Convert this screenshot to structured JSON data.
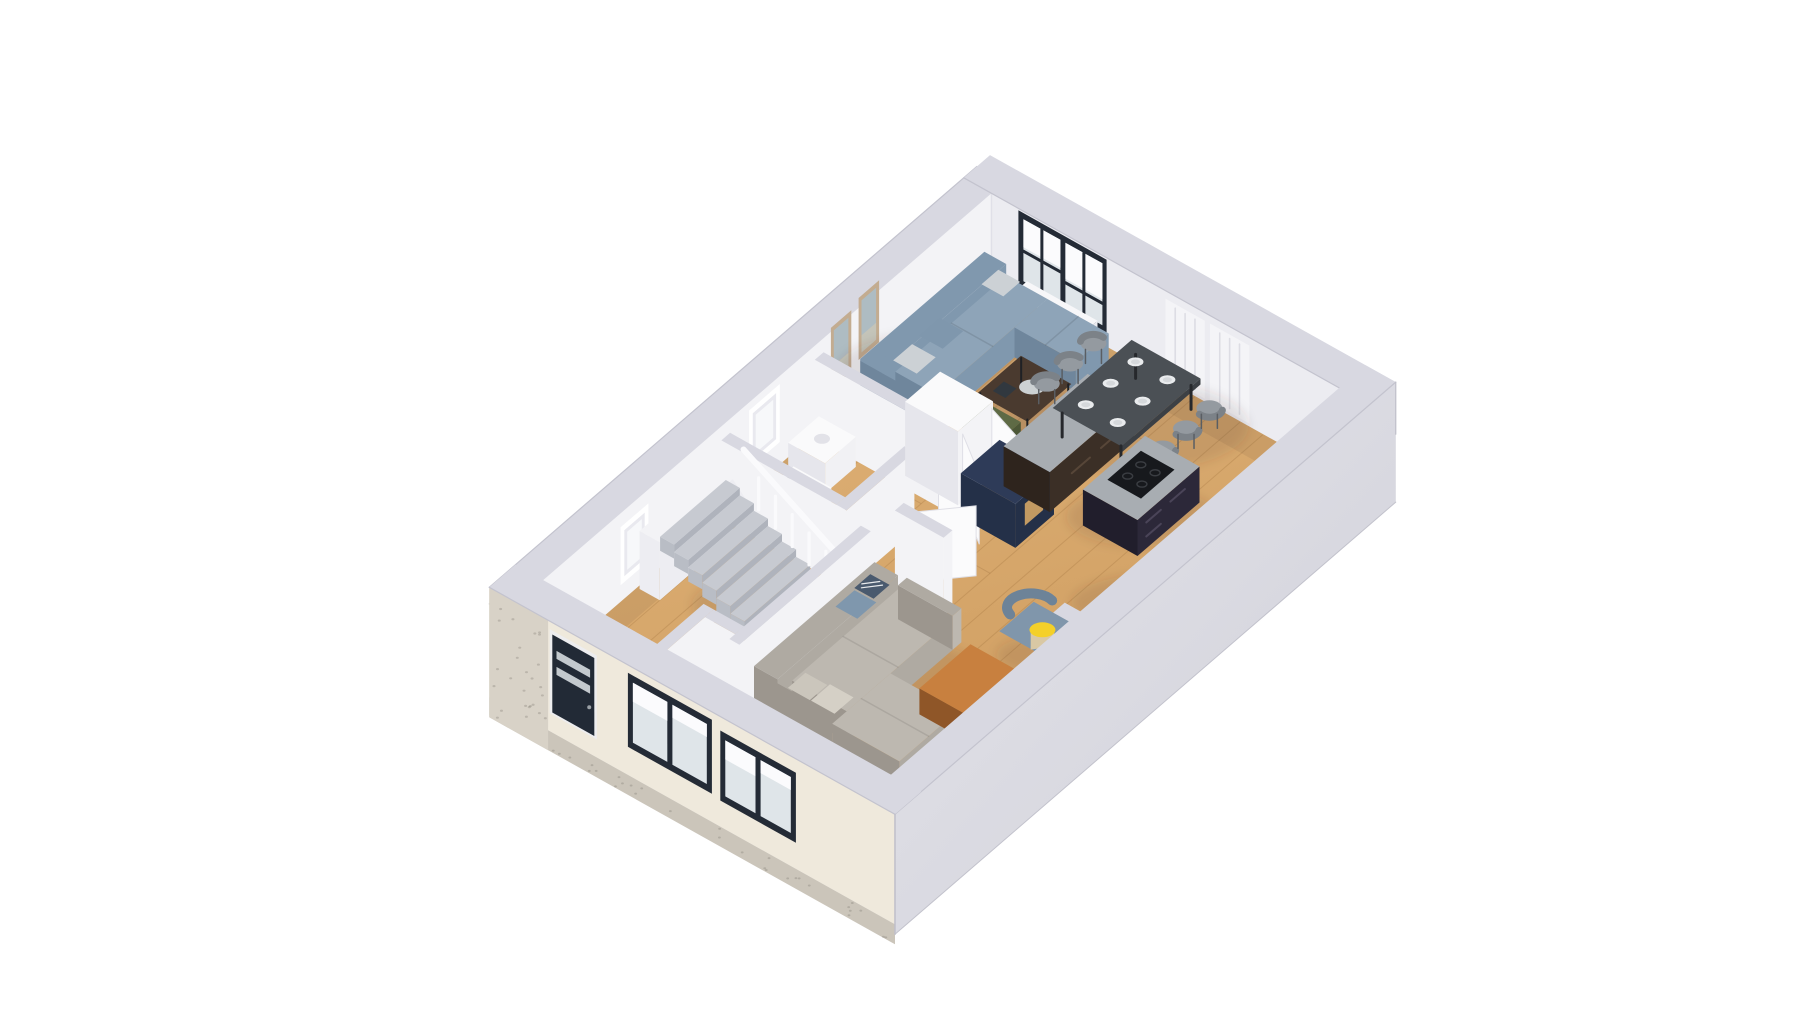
{
  "scene": {
    "type": "3d-floor-plan-render",
    "view": "isometric-top-down",
    "background": "#ffffff"
  },
  "palette": {
    "background": "#ffffff",
    "floor_light": "#DFB277",
    "floor_dark": "#CE9C5F",
    "plank_line": "rgba(139,94,45,0.22)",
    "plank_seam": "rgba(120,80,40,0.18)",
    "wall_interior": "#F3F3F6",
    "wall_interior_2": "#ECECF1",
    "wall_top": "#D8D8E1",
    "wall_top_edge": "#C3C3CE",
    "wall_exterior": "#DEDEE5",
    "wall_exterior_dark": "#CFCFD8",
    "facade_cream": "#EFE9DC",
    "facade_brick": "#D8D2C7",
    "speckle": "rgba(120,115,105,0.30)",
    "plinth": "#CBC5BA",
    "door_dark": "#222A36",
    "door_frame": "#EDEDEF",
    "window_frame": "#242B36",
    "glass_white": "#F7F8FA",
    "glass_gray": "#DFE5E9",
    "blind_white": "#FBFBFD",
    "radiator": "#F7F7F9",
    "radiator_line": "#E0E0E8",
    "curtain": "#F4F4F7",
    "curtain_line": "#DDDDE4",
    "picture_frame": "#C3AC90",
    "picture_art": "#AEBCC2",
    "picture_art2": "#C9C5B6",
    "sofa_blue": "#8098AE",
    "sofa_blue_light": "#8EA4B8",
    "sofa_blue_dark": "#6F869C",
    "pillow_blue": "#7F97AD",
    "pillow_pattern": "#4A5A6E",
    "pillow_light": "#CCD1D5",
    "sofa_greige": "#AFAAA2",
    "sofa_greige_light": "#BDB8B0",
    "sofa_greige_dark": "#9C968E",
    "pillow_greige": "#CBC6BC",
    "ottoman_orange": "#C8803F",
    "ottoman_orange_mid": "#A96630",
    "ottoman_orange_dark": "#8F5628",
    "table_wood": "#4A3A2F",
    "table_frame": "#1F2125",
    "tray": "#D3D9DC",
    "pouf_olive": "#5E6A45",
    "pouf_olive_dark": "#4C5737",
    "dining_table": "#4B5055",
    "dining_table_dark": "#3C4045",
    "chair_gray": "#949AA0",
    "chair_gray_dark": "#7C8288",
    "plate": "#E9EBED",
    "plate_inner": "#D5D8DB",
    "island_top": "#A8ADB2",
    "island_base": "#2C2839",
    "island_base_dark": "#211E2C",
    "cooktop": "#17191D",
    "cooktop_ring": "#3A3D42",
    "kitchen_cab_brown": "#3B2F26",
    "kitchen_cab_brown_dark": "#2E241D",
    "navy_cabinet": "#2E3B58",
    "navy_cabinet_dark": "#243048",
    "wood_board": "#C29A62",
    "counter_base": "#34303F",
    "sink_steel": "#C9CED3",
    "sink_inner": "#9AA2A9",
    "stair_tread": "#C7CAD1",
    "stair_riser": "#AFB3BC",
    "stair_skirt": "#B9BDC5",
    "rail_white": "#FAFAFC",
    "fridge_white": "#FAFAFB",
    "fridge_shadow": "#E6E6EC",
    "leaf_white": "#FBFBFC",
    "leaf_edge": "#DFDFE6",
    "lamp_yellow": "#F4D029",
    "lamp_shade": "#D9C8A4",
    "lamp_stand": "#8A8D90",
    "plant_green": "#5E7A46",
    "plant_green_dark": "#49633A",
    "plant_green_light": "#71915A",
    "console_dark": "#2D2925",
    "vase_white": "#F2F2F2",
    "armchair_blue": "#8096AB",
    "armchair_blue_dark": "#6D8398",
    "shadow": "rgba(70,55,40,0.12)",
    "inner_wall_shadow": "rgba(90,70,50,0.10)"
  },
  "inventory": {
    "rooms": [
      {
        "name": "living-area-upper",
        "items": [
          "corner-sofa-blue",
          "coffee-table",
          "green-pouf",
          "wall-art-frames",
          "window-large",
          "curtain-panels",
          "radiator"
        ]
      },
      {
        "name": "kitchen",
        "items": [
          "island-with-cooktop",
          "counter-with-sink",
          "navy-cabinet",
          "brown-counter",
          "fridge-with-open-doors"
        ]
      },
      {
        "name": "dining-area",
        "items": [
          "dining-table",
          "six-chairs",
          "table-settings"
        ]
      },
      {
        "name": "living-area-lower",
        "items": [
          "sectional-sofa-greige",
          "orange-ottoman",
          "armchair-gray",
          "floor-lamp-yellow",
          "console-with-plants",
          "armchair-blue"
        ]
      },
      {
        "name": "wc",
        "items": [
          "vanity-sink",
          "washing-machine"
        ]
      },
      {
        "name": "hall",
        "items": [
          "staircase",
          "balustrade",
          "entry-door-dark",
          "coat-panel"
        ]
      }
    ]
  }
}
